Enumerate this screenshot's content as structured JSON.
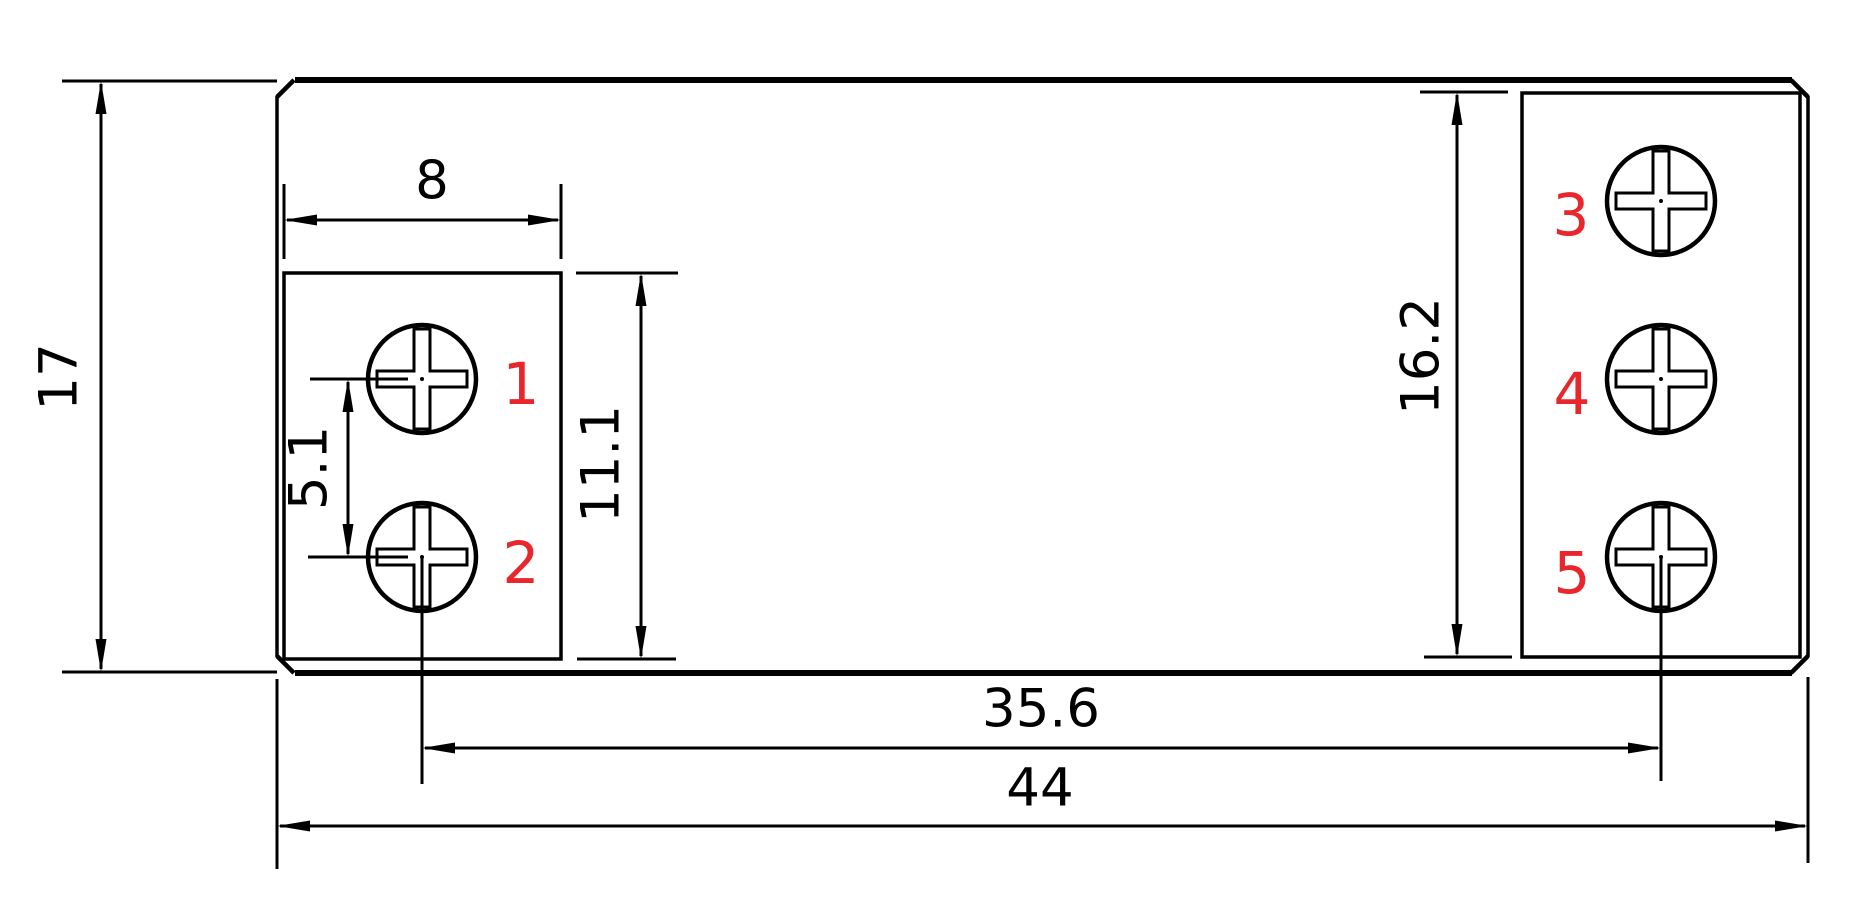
{
  "dimensions": {
    "overall_height": "17",
    "overall_width": "44",
    "pocket_width": "8",
    "screw_pitch": "5.1",
    "left_pocket_height": "11.1",
    "right_pocket_height": "16.2",
    "screw_center_span": "35.6"
  },
  "terminal_labels": [
    "1",
    "2",
    "3",
    "4",
    "5"
  ],
  "colors": {
    "line": "#000000",
    "label": "#e8262b",
    "background": "#ffffff"
  }
}
